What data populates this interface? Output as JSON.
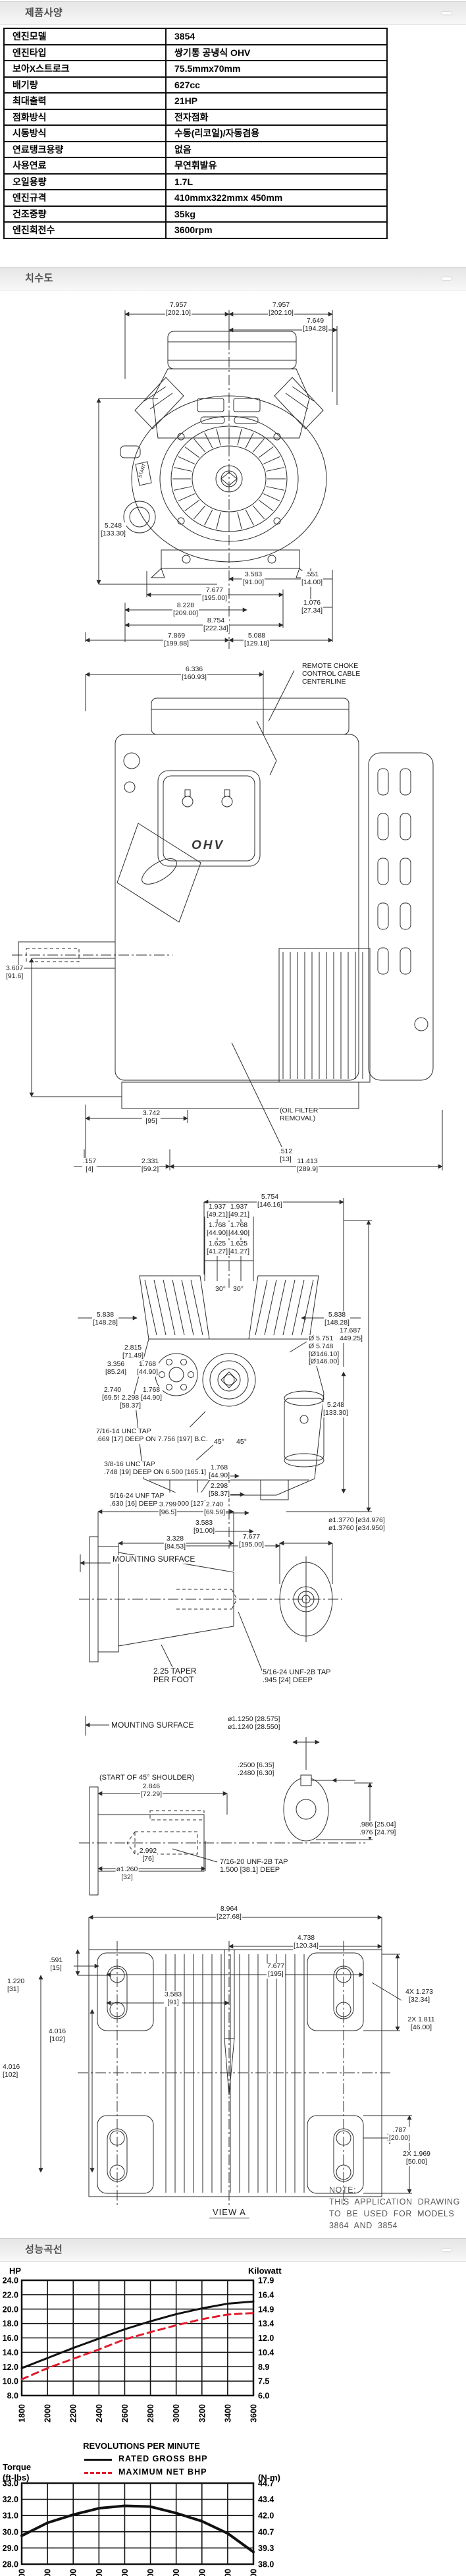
{
  "sections": {
    "specs": {
      "title": "제품사양"
    },
    "dimensions": {
      "title": "치수도"
    },
    "performance": {
      "title": "성능곡선"
    }
  },
  "spec_table": {
    "rows": [
      {
        "label": "엔진모델",
        "value": "3854"
      },
      {
        "label": "엔진타입",
        "value": "쌍기통 공냉식 OHV"
      },
      {
        "label": "보아X스트로크",
        "value": "75.5mmx70mm"
      },
      {
        "label": "배기량",
        "value": "627cc"
      },
      {
        "label": "최대출력",
        "value": "21HP"
      },
      {
        "label": "점화방식",
        "value": "전자점화"
      },
      {
        "label": "시동방식",
        "value": "수동(리코일)/자동겸용"
      },
      {
        "label": "연료탱크용량",
        "value": "없음"
      },
      {
        "label": "사용연료",
        "value": "무연휘발유"
      },
      {
        "label": "오일용량",
        "value": "1.7L"
      },
      {
        "label": "엔진규격",
        "value": "410mmx322mmx 450mm"
      },
      {
        "label": "건조중량",
        "value": "35kg"
      },
      {
        "label": "엔진회전수",
        "value": "3600rpm"
      }
    ]
  },
  "drawing": {
    "ohv_badge": "OHV",
    "view_a_label": "VIEW A",
    "note_lines": "NOTE:\nTHIS  APPLICATION  DRAWING\nTO  BE  USED  FOR  MODELS\n3864  AND  3854",
    "labels": [
      {
        "x": 271,
        "y": 3,
        "t": "7.957\n[202.10]"
      },
      {
        "x": 427,
        "y": 3,
        "t": "7.957\n[202.10]"
      },
      {
        "x": 479,
        "y": 27,
        "t": "7.649\n[194.28]"
      },
      {
        "x": 172,
        "y": 338,
        "t": "5.248\n[133.30]"
      },
      {
        "x": 217,
        "y": 256,
        "t": "START",
        "s": 7,
        "r": -72
      },
      {
        "x": 385,
        "y": 412,
        "t": "3.583\n[91.00]"
      },
      {
        "x": 474,
        "y": 412,
        "t": ".551\n[14.00]"
      },
      {
        "x": 326,
        "y": 436,
        "t": "7.677\n[195.00]"
      },
      {
        "x": 474,
        "y": 455,
        "t": "1.076\n[27.34]"
      },
      {
        "x": 282,
        "y": 459,
        "t": "8.228\n[209.00]"
      },
      {
        "x": 328,
        "y": 482,
        "t": "8.754\n[222.34]"
      },
      {
        "x": 268,
        "y": 505,
        "t": "7.869\n[199.88]"
      },
      {
        "x": 390,
        "y": 505,
        "t": "5.088\n[129.18]"
      },
      {
        "x": 295,
        "y": 556,
        "t": "6.336\n[160.93]"
      },
      {
        "x": 458,
        "y": 551,
        "t": "REMOTE CHOKE\nCONTROL CABLE\nCENTERLINE",
        "a": "l"
      },
      {
        "x": 8,
        "y": 1010,
        "t": "3.607\n[91.6]",
        "a": "l"
      },
      {
        "x": 424,
        "y": 1226,
        "t": "(OIL FILTER\nREMOVAL)",
        "a": "l"
      },
      {
        "x": 434,
        "y": 1288,
        "t": ".512\n[13]"
      },
      {
        "x": 230,
        "y": 1230,
        "t": "3.742\n[95]"
      },
      {
        "x": 136,
        "y": 1303,
        "t": ".157\n[4]"
      },
      {
        "x": 228,
        "y": 1303,
        "t": "2.331\n[59.2]"
      },
      {
        "x": 467,
        "y": 1303,
        "t": "11.413\n[289.9]"
      },
      {
        "x": 410,
        "y": 1357,
        "t": "5.754\n[146.16]"
      },
      {
        "x": 330,
        "y": 1372,
        "t": "1.937\n[49.21]"
      },
      {
        "x": 363,
        "y": 1372,
        "t": "1.937\n[49.21]"
      },
      {
        "x": 330,
        "y": 1400,
        "t": "1.768\n[44.90]"
      },
      {
        "x": 363,
        "y": 1400,
        "t": "1.768\n[44.90]"
      },
      {
        "x": 330,
        "y": 1428,
        "t": "1.625\n[41.27]"
      },
      {
        "x": 363,
        "y": 1428,
        "t": "1.625\n[41.27]"
      },
      {
        "x": 532,
        "y": 1560,
        "t": "17.687\n[449.25]"
      },
      {
        "x": 160,
        "y": 1536,
        "t": "5.838\n[148.28]"
      },
      {
        "x": 512,
        "y": 1536,
        "t": "5.838\n[148.28]"
      },
      {
        "x": 202,
        "y": 1586,
        "t": "2.815\n[71.49]"
      },
      {
        "x": 176,
        "y": 1611,
        "t": "3.356\n[85.24]"
      },
      {
        "x": 224,
        "y": 1611,
        "t": "1.768\n[44.90]"
      },
      {
        "x": 468,
        "y": 1572,
        "t": "Ø 5.751\nØ 5.748\n[Ø146.10]\n[Ø146.00]",
        "a": "l"
      },
      {
        "x": 171,
        "y": 1650,
        "t": "2.740\n[69.59]"
      },
      {
        "x": 198,
        "y": 1662,
        "t": "2.298\n[58.37]"
      },
      {
        "x": 230,
        "y": 1650,
        "t": "1.768\n[44.90]"
      },
      {
        "x": 145,
        "y": 1713,
        "t": "7/16-14 UNC TAP\n.669 [17] DEEP ON 7.756 [197] B.C.",
        "a": "l"
      },
      {
        "x": 157,
        "y": 1763,
        "t": "3/8-16 UNC TAP\n.748 [19] DEEP ON 6.500 [165.1] B.C.",
        "a": "l"
      },
      {
        "x": 166,
        "y": 1811,
        "t": "5/16-24 UNF TAP\n.630 [16] DEEP ON 5.000 [127] B.C.",
        "a": "l"
      },
      {
        "x": 510,
        "y": 1673,
        "t": "5.248\n[133.30]"
      },
      {
        "x": 335,
        "y": 1497,
        "t": "30°"
      },
      {
        "x": 362,
        "y": 1497,
        "t": "30°"
      },
      {
        "x": 333,
        "y": 1729,
        "t": "45°"
      },
      {
        "x": 367,
        "y": 1729,
        "t": "45°"
      },
      {
        "x": 333,
        "y": 1768,
        "t": "1.768\n[44.90]"
      },
      {
        "x": 333,
        "y": 1796,
        "t": "2.298\n[58.37]"
      },
      {
        "x": 326,
        "y": 1824,
        "t": "2.740\n[69.59]"
      },
      {
        "x": 310,
        "y": 1852,
        "t": "3.583\n[91.00]"
      },
      {
        "x": 382,
        "y": 1873,
        "t": "7.677\n[195.00]"
      },
      {
        "x": 170,
        "y": 1906,
        "t": "MOUNTING  SURFACE",
        "a": "l",
        "s": 12
      },
      {
        "x": 255,
        "y": 1824,
        "t": "3.799\n[96.5]"
      },
      {
        "x": 266,
        "y": 1876,
        "t": "3.328\n[84.53]"
      },
      {
        "x": 498,
        "y": 1848,
        "t": "ø1.3770 [ø34.976]\nø1.3760 [ø34.950]",
        "a": "l"
      },
      {
        "x": 232,
        "y": 2076,
        "t": "2.25 TAPER\nPER FOOT",
        "a": "l",
        "s": 12
      },
      {
        "x": 398,
        "y": 2078,
        "t": "5/16-24 UNF-2B TAP\n.945 [24] DEEP",
        "a": "l",
        "s": 11
      },
      {
        "x": 168,
        "y": 2158,
        "t": "MOUNTING  SURFACE",
        "a": "l",
        "s": 12
      },
      {
        "x": 150,
        "y": 2238,
        "t": "(START OF 45° SHOULDER)",
        "a": "l",
        "s": 11
      },
      {
        "x": 230,
        "y": 2252,
        "t": "2.846\n[72.29]"
      },
      {
        "x": 345,
        "y": 2150,
        "t": "ø1.1250 [28.575]\nø1.1240 [28.550]",
        "a": "l"
      },
      {
        "x": 360,
        "y": 2220,
        "t": ".2500 [6.35]\n.2480 [6.30]",
        "a": "l"
      },
      {
        "x": 545,
        "y": 2310,
        "t": ".986 [25.04]\n.976 [24.79]",
        "a": "l"
      },
      {
        "x": 225,
        "y": 2350,
        "t": "2.992\n[76]"
      },
      {
        "x": 193,
        "y": 2378,
        "t": "ø1.260\n[32]"
      },
      {
        "x": 333,
        "y": 2366,
        "t": "7/16-20 UNF-2B TAP\n1.500 [38.1] DEEP",
        "a": "l",
        "s": 11
      },
      {
        "x": 348,
        "y": 2438,
        "t": "8.964\n[227.68]"
      },
      {
        "x": 465,
        "y": 2482,
        "t": "4.738\n[120.34]"
      },
      {
        "x": 419,
        "y": 2525,
        "t": "7.677\n[195]"
      },
      {
        "x": 263,
        "y": 2568,
        "t": "3.583\n[91]"
      },
      {
        "x": 637,
        "y": 2564,
        "t": "4X 1.273\n[32.34]"
      },
      {
        "x": 640,
        "y": 2606,
        "t": "2X 1.811\n[46.00]"
      },
      {
        "x": 10,
        "y": 2548,
        "t": "1.220\n[31]",
        "a": "l"
      },
      {
        "x": 85,
        "y": 2516,
        "t": ".591\n[15]"
      },
      {
        "x": 3,
        "y": 2678,
        "t": "4.016\n[102]",
        "a": "l"
      },
      {
        "x": 87,
        "y": 2624,
        "t": "4.016\n[102]"
      },
      {
        "x": 607,
        "y": 2774,
        "t": ".787\n[20.00]"
      },
      {
        "x": 633,
        "y": 2810,
        "t": "2X 1.969\n[50.00]"
      }
    ]
  },
  "chart_data": [
    {
      "type": "line",
      "title_left": "HP",
      "title_right": "Kilowatt",
      "xlabel": "REVOLUTIONS  PER  MINUTE",
      "x": [
        1800,
        2000,
        2200,
        2400,
        2600,
        2800,
        3000,
        3200,
        3400,
        3600
      ],
      "ylim": [
        8,
        24
      ],
      "y_left_ticks": [
        "24.0",
        "22.0",
        "20.0",
        "18.0",
        "16.0",
        "14.0",
        "12.0",
        "10.0",
        "8.0"
      ],
      "y_right_ticks": [
        "17.9",
        "16.4",
        "14.9",
        "13.4",
        "12.0",
        "10.4",
        "8.9",
        "7.5",
        "6.0"
      ],
      "legend_position": "below",
      "grid": true,
      "series": [
        {
          "name": "RATED  GROSS  BHP",
          "style": "solid",
          "color": "#111111",
          "values": [
            11.8,
            13.2,
            14.6,
            15.9,
            17.2,
            18.3,
            19.3,
            20.1,
            20.75,
            21.05
          ]
        },
        {
          "name": "MAXIMUM  NET  BHP",
          "style": "dashed",
          "color": "#e01b2c",
          "values": [
            10.25,
            11.8,
            13.1,
            14.4,
            15.8,
            16.8,
            17.75,
            18.6,
            19.25,
            19.45
          ]
        }
      ]
    },
    {
      "type": "line",
      "title_left_1": "Torque",
      "title_left_2": "(ft-lbs)",
      "title_right": "(N-m)",
      "x": [
        1800,
        2000,
        2200,
        2400,
        2600,
        2800,
        3000,
        3200,
        3400,
        3600
      ],
      "ylim": [
        28,
        33
      ],
      "y_left_ticks": [
        "33.0",
        "32.0",
        "31.0",
        "30.0",
        "29.0",
        "28.0"
      ],
      "y_right_ticks": [
        "44.7",
        "43.4",
        "42.0",
        "40.7",
        "39.3",
        "38.0"
      ],
      "grid": true,
      "series": [
        {
          "name": "TORQUE",
          "style": "solid",
          "color": "#111111",
          "values": [
            29.75,
            30.55,
            31.05,
            31.45,
            31.6,
            31.55,
            31.15,
            30.65,
            29.9,
            28.75
          ]
        }
      ]
    }
  ]
}
